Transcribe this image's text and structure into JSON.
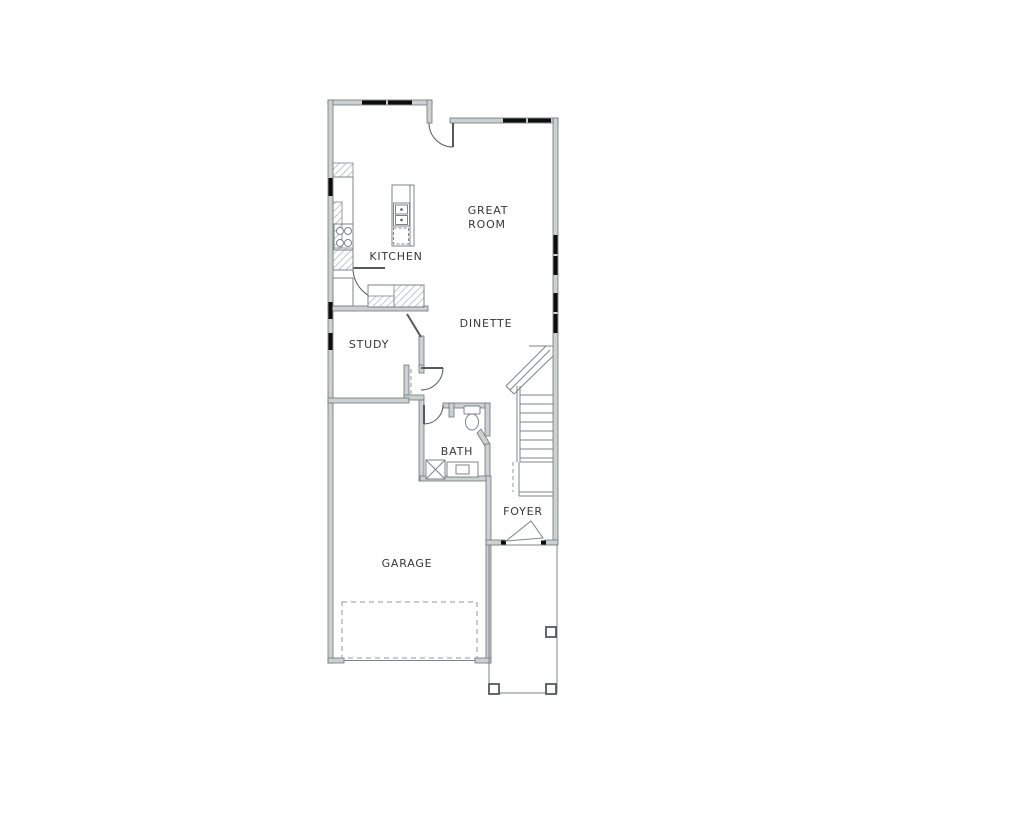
{
  "rooms": {
    "great_room": {
      "line1": "GREAT",
      "line2": "ROOM"
    },
    "kitchen": {
      "label": "KITCHEN"
    },
    "dinette": {
      "label": "DINETTE"
    },
    "study": {
      "label": "STUDY"
    },
    "bath": {
      "label": "BATH"
    },
    "foyer": {
      "label": "FOYER"
    },
    "garage": {
      "label": "GARAGE"
    }
  },
  "colors": {
    "wall_fill": "#cbd0d0",
    "wall_stroke": "#6e7779",
    "line": "#7c8486",
    "line_dark": "#55595a",
    "window": "#0d0d0d",
    "text": "#383838",
    "hatch": "#a2aaac",
    "dash": "#8f9799"
  }
}
